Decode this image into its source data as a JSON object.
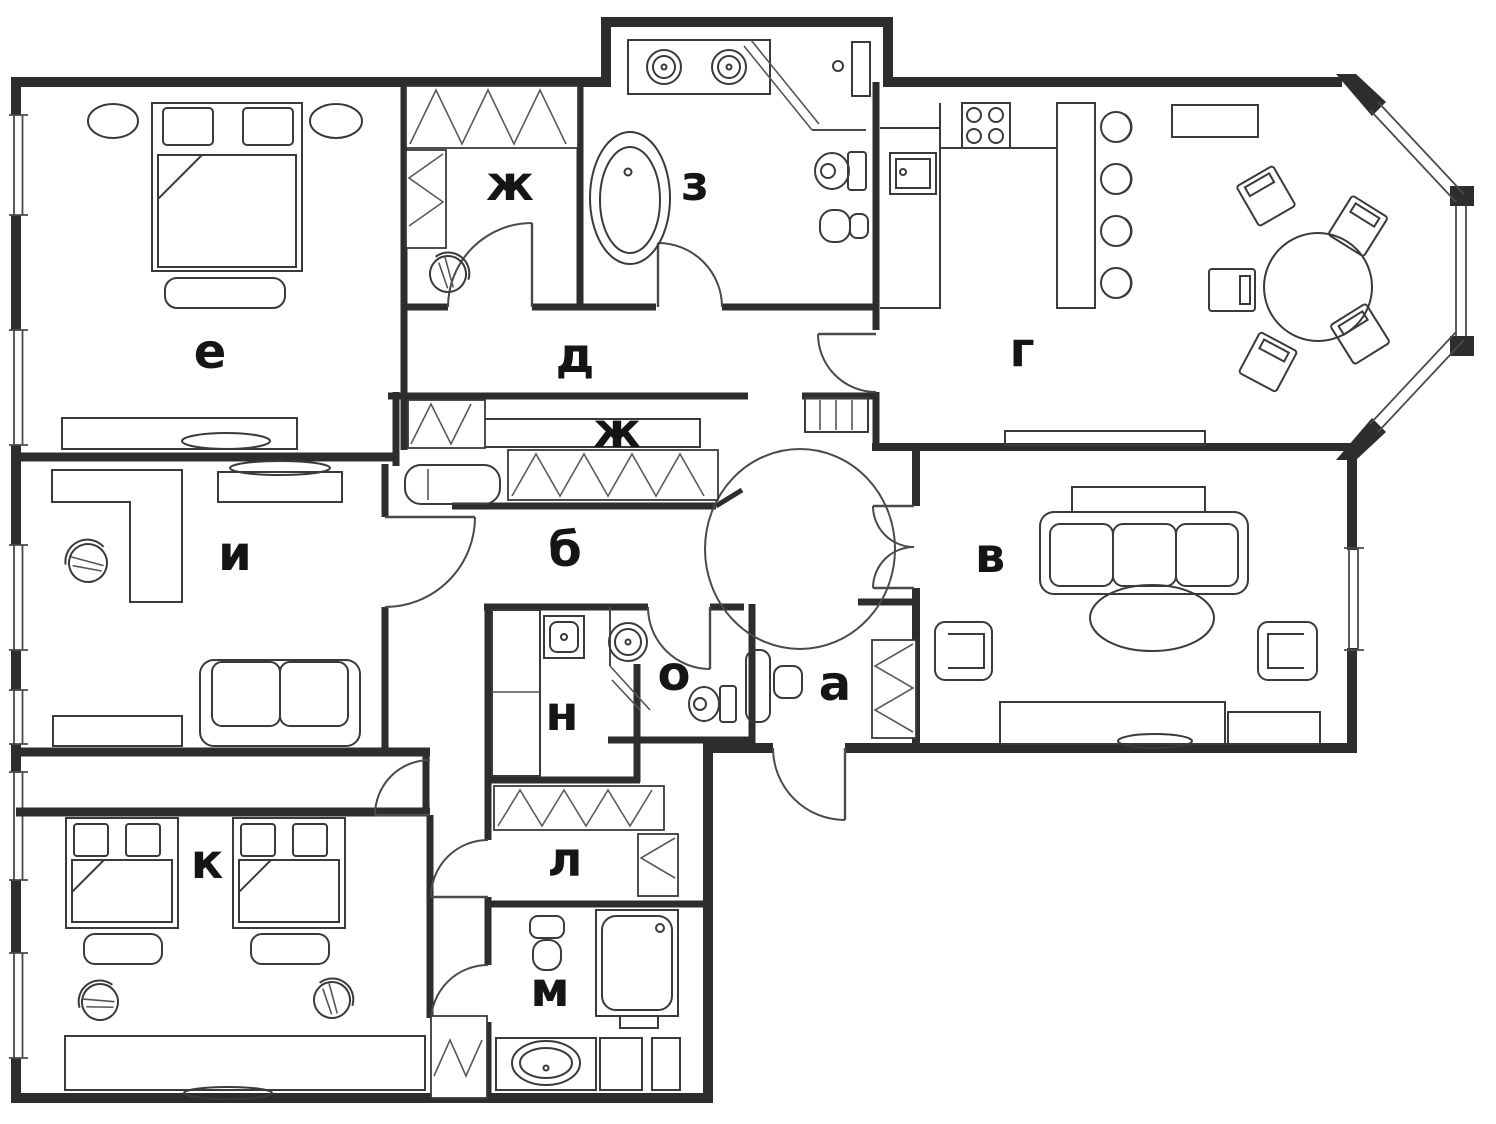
{
  "floor_plan": {
    "type": "apartment-floor-plan",
    "rooms": [
      {
        "id": "bedroom-master",
        "label": "е"
      },
      {
        "id": "wardrobe-top",
        "label": "ж"
      },
      {
        "id": "bathroom-main",
        "label": "з"
      },
      {
        "id": "hallway-upper",
        "label": "д"
      },
      {
        "id": "kitchen-dining",
        "label": "г"
      },
      {
        "id": "wardrobe-middle",
        "label": "ж"
      },
      {
        "id": "study",
        "label": "и"
      },
      {
        "id": "corridor",
        "label": "б"
      },
      {
        "id": "living-room",
        "label": "в"
      },
      {
        "id": "wc",
        "label": "о"
      },
      {
        "id": "entrance-hall",
        "label": "а"
      },
      {
        "id": "laundry",
        "label": "н"
      },
      {
        "id": "bedroom-kids",
        "label": "к"
      },
      {
        "id": "wardrobe-lower",
        "label": "л"
      },
      {
        "id": "bathroom-second",
        "label": "м"
      }
    ],
    "colors": {
      "line": "#2d2d2d",
      "background": "#ffffff",
      "label": "#151515"
    }
  }
}
